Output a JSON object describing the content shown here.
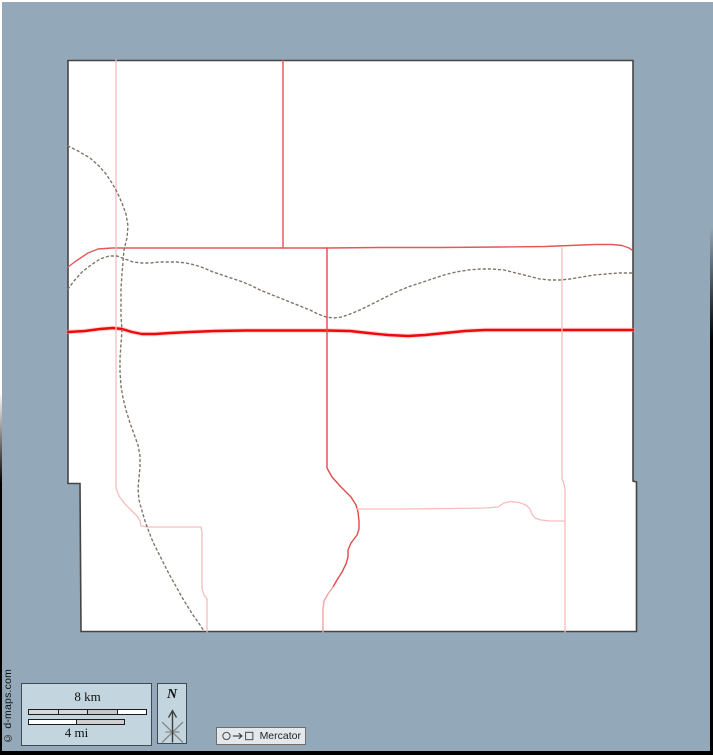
{
  "canvas": {
    "width": 713,
    "height": 755,
    "background": "#93a9b9"
  },
  "map": {
    "fill": "#ffffff",
    "outline_color": "#454545",
    "outline_points": "68,60.5 633,60.5 633,481 636.5,482 636.5,631.5 81,631.5 80,483.5 68,483.5",
    "paths": [
      {
        "name": "main-highway-halo",
        "points": "68,332 85,331 100,329 113,328 122,329 132,332 142,334 155,334 170,333 190,332 215,331 245,330.5 280,330.5 327,330.5 350,331 368,333 388,335 408,336 425,335 445,333 465,331 485,330 510,330 540,330 575,330 605,330 633,330",
        "color": "#ff9d9d",
        "width": 4.6,
        "dash": "",
        "opacity": 0.45
      },
      {
        "name": "main-highway",
        "points": "68,332 85,331 100,329 113,328 122,329 132,332 142,334 155,334 170,333 190,332 215,331 245,330.5 280,330.5 327,330.5 350,331 368,333 388,335 408,336 425,335 445,333 465,331 485,330 510,330 540,330 575,330 605,330 633,330",
        "color": "#ee0a0a",
        "width": 2.4,
        "dash": "",
        "opacity": 1
      },
      {
        "name": "north-horizontal-road",
        "points": "68,267 76,261 88,253 98,249 112,248 150,248 200,248 283,248 327,248 380,247.5 440,247.5 500,247 545,246.5 570,245.5 595,244.5 612,244.5 622,245.5 629,248 632,250",
        "color": "#e25858",
        "width": 1.4,
        "dash": "",
        "opacity": 1
      },
      {
        "name": "north-vertical-road",
        "points": "283,60 283,248",
        "color": "#e05555",
        "width": 1.4,
        "dash": "",
        "opacity": 1
      },
      {
        "name": "central-road",
        "points": "327,248 327,400 327,468 332,477 341,487 351,497 356,505 358,512 359,521 359,529 357,535 351,543 348,550 348,557 346,564 342,572 337,580 333,587",
        "color": "#e04b4b",
        "width": 1.4,
        "dash": "",
        "opacity": 1
      },
      {
        "name": "central-road-tail",
        "points": "333,587 328,594 324,601 323,609 323,620 323,632",
        "color": "#f2a2a2",
        "width": 1.4,
        "dash": "",
        "opacity": 1
      },
      {
        "name": "west-road",
        "points": "116,60 116,200 116,330 116,420 116,488 119,496 125,504 131,510 137,516 140,521 141,526 148,527 160,527 201,527 202,533 202,560 202,588 204,595 207,599 207,615 207,632",
        "color": "#f6bdbd",
        "width": 1.3,
        "dash": "",
        "opacity": 1
      },
      {
        "name": "east-vertical-road",
        "points": "562,248 562,350 562,478 564,484 565,490 565,560 565,632",
        "color": "#f6bdbd",
        "width": 1.3,
        "dash": "",
        "opacity": 1
      },
      {
        "name": "south-horizontal-road",
        "points": "357,509 400,509 450,508.5 485,508 498,507 504,503 511,501.5 519,502.5 526,505 530,509 532,514 535,518 541,520 550,521 561,521 565,521",
        "color": "#f6bdbd",
        "width": 1.3,
        "dash": "",
        "opacity": 1
      },
      {
        "name": "stream-north-south",
        "points": "68,146 78,151 90,158 99,166 106,174 112,183 117,192 122,203 126,214 128,226 127,238 124,250 123,262 122,274 121,288 121,302 121,316 122,330 121,344 120,358 120,372 121,386 123,398 126,410 130,423 134,434 138,445 140,456 140,467 139,478 138,489 139,500 142,511 145,521 149,532 153,542 158,552 163,562 168,572 173,581 178,590 183,599 188,607 193,615 198,622 202,628 204,631",
        "color": "#7e7569",
        "width": 1.4,
        "dash": "2 3.1",
        "opacity": 1
      },
      {
        "name": "stream-east-west",
        "points": "68,289 74,281 82,272 91,265 100,259 109,256 117,256 125,259 133,262 141,263 150,263 159,262 168,262 177,262 186,263 195,265 204,268 213,272 222,275 231,278 240,281 250,285 260,290 270,294 280,298 290,302 300,306 310,310 318,314 326,317 334,318 342,317 350,314 360,310 372,304 384,298 396,292 408,287 420,283 432,279 444,275 456,272 468,270 480,269 492,269 504,270 516,273 528,276 540,279 550,280 560,280 570,279 582,277 594,275 606,274 618,273 632,273",
        "color": "#7e7569",
        "width": 1.4,
        "dash": "2 3.1",
        "opacity": 1
      }
    ]
  },
  "legend": {
    "scale": {
      "km_label": "8 km",
      "mi_label": "4 mi",
      "km_segments": [
        "#d8d8d8",
        "#d8d8d8",
        "#c6c6c6",
        "#ffffff"
      ],
      "mi_segments": [
        "#ffffff",
        "#cfcfcf"
      ]
    },
    "north": {
      "label": "N"
    },
    "projection": {
      "label": "Mercator"
    },
    "copyright": "© d-maps.com"
  }
}
